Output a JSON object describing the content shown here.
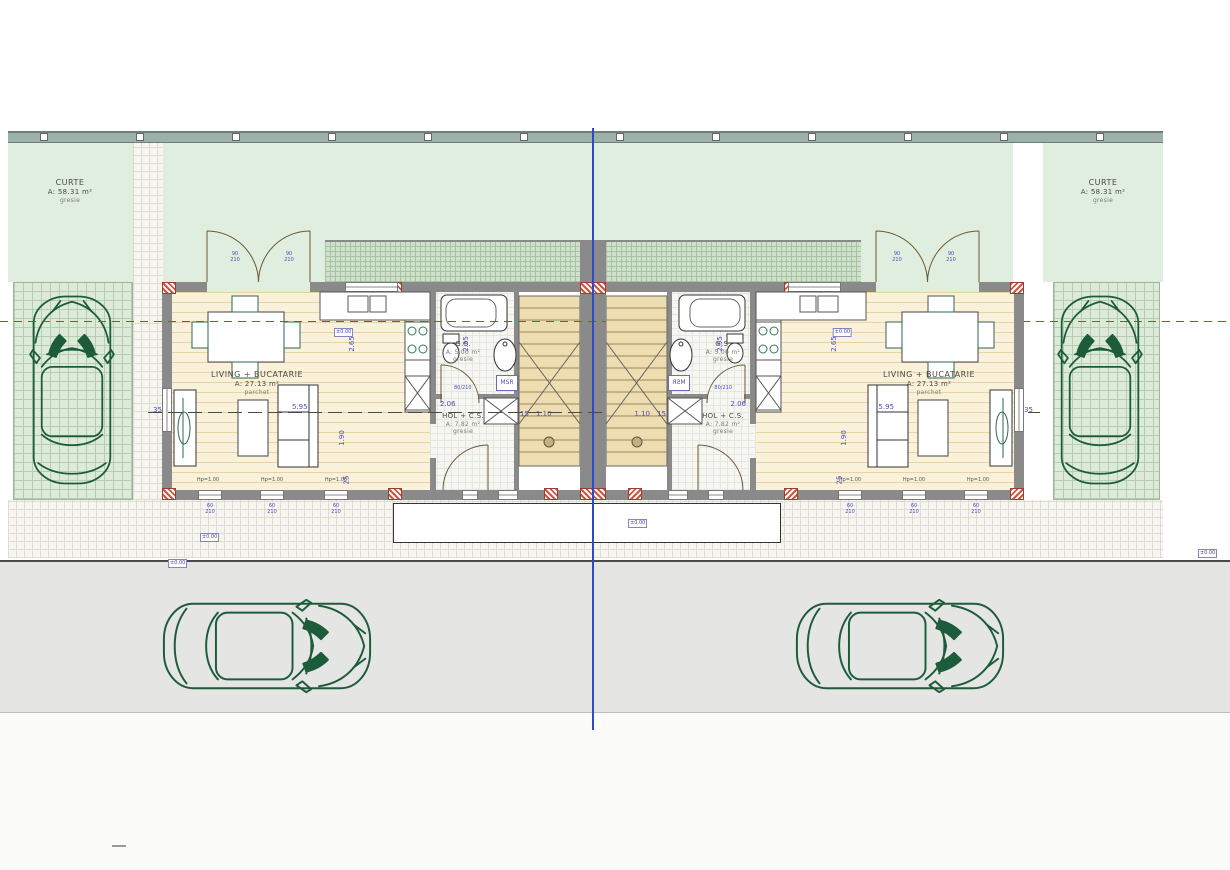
{
  "drawing": {
    "site": {
      "curte": {
        "name": "CURTE",
        "area": "A: 58.31 m²",
        "finish": "gresie"
      }
    },
    "unit": {
      "living": {
        "name": "LIVING + BUCATARIE",
        "area": "A: 27.13 m²",
        "finish": "parchet"
      },
      "bathroom": {
        "name": "G.S.",
        "area": "A: 5.00 m²",
        "finish": "gresie"
      },
      "hall": {
        "name": "HOL + C.S.",
        "area": "A: 7.82 m²",
        "finish": "gresie"
      },
      "washer_label": "MSR",
      "dims": {
        "living_width": "5.95",
        "living_depth": "2.65",
        "sofa_zone": "1.90",
        "hall_width": "2.06",
        "bath_depth": "2.55",
        "stair_step": "15",
        "stair_flight": "1.10",
        "wall_tick": "35",
        "front_tick": "25",
        "bath_door": "80/210",
        "entry_leaf_w": "90",
        "entry_leaf_h": "210",
        "window_w": "60",
        "window_h": "210",
        "window_parapet": "Hp=1.00"
      }
    },
    "markers": {
      "level": "±0.00"
    },
    "colors": {
      "yard_green": "#dfeede",
      "pad_green": "#dcead7",
      "wall_gray": "#8a8a8a",
      "hatch_red": "#cc5544",
      "centerline_blue": "#2b4bc8",
      "axis_red": "#cc3333",
      "car_green": "#1d5c3a",
      "wood_floor": "#f9f1da",
      "street_gray": "#e5e5e3"
    }
  }
}
